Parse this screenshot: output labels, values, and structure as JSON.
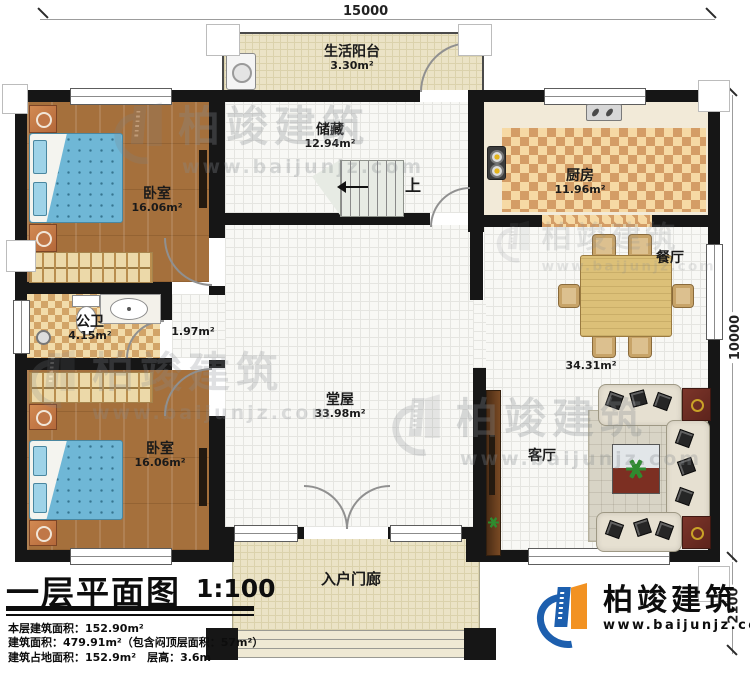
{
  "dims": {
    "width": "15000",
    "depth": "10000",
    "porch_depth": "2100"
  },
  "rooms": {
    "balcony": {
      "name": "生活阳台",
      "area": "3.30m²"
    },
    "storage": {
      "name": "储藏",
      "area": "12.94m²"
    },
    "kitchen": {
      "name": "厨房",
      "area": "11.96m²"
    },
    "bedroom1": {
      "name": "卧室",
      "area": "16.06m²"
    },
    "bedroom2": {
      "name": "卧室",
      "area": "16.06m²"
    },
    "bathroom": {
      "name": "公卫",
      "area": "4.15m²"
    },
    "corridor": {
      "area": "1.97m²"
    },
    "hall": {
      "name": "堂屋",
      "area": "33.98m²"
    },
    "dining": {
      "name": "餐厅"
    },
    "living": {
      "name": "客厅"
    },
    "dining_living_area": "34.31m²",
    "porch": {
      "name": "入户门廊"
    },
    "stairs": {
      "up": "上"
    }
  },
  "titleblock": {
    "title": "一层平面图",
    "scale": "1:100",
    "stats": [
      "本层建筑面积：152.90m²",
      "建筑面积：479.91m²（包含闷顶层面积：57m²）",
      "建筑占地面积：152.9m²　层高：3.6m"
    ]
  },
  "brand": {
    "name": "柏竣建筑",
    "url": "www.baijunjz.com"
  },
  "watermark": {
    "name": "柏竣建筑",
    "url": "www.baijunjz.com"
  },
  "colors": {
    "wall": "#161616",
    "logo_blue": "#1d5fae",
    "logo_orange": "#f29222",
    "wood": "#a9713a",
    "bed_blue": "#6fb7d6"
  }
}
